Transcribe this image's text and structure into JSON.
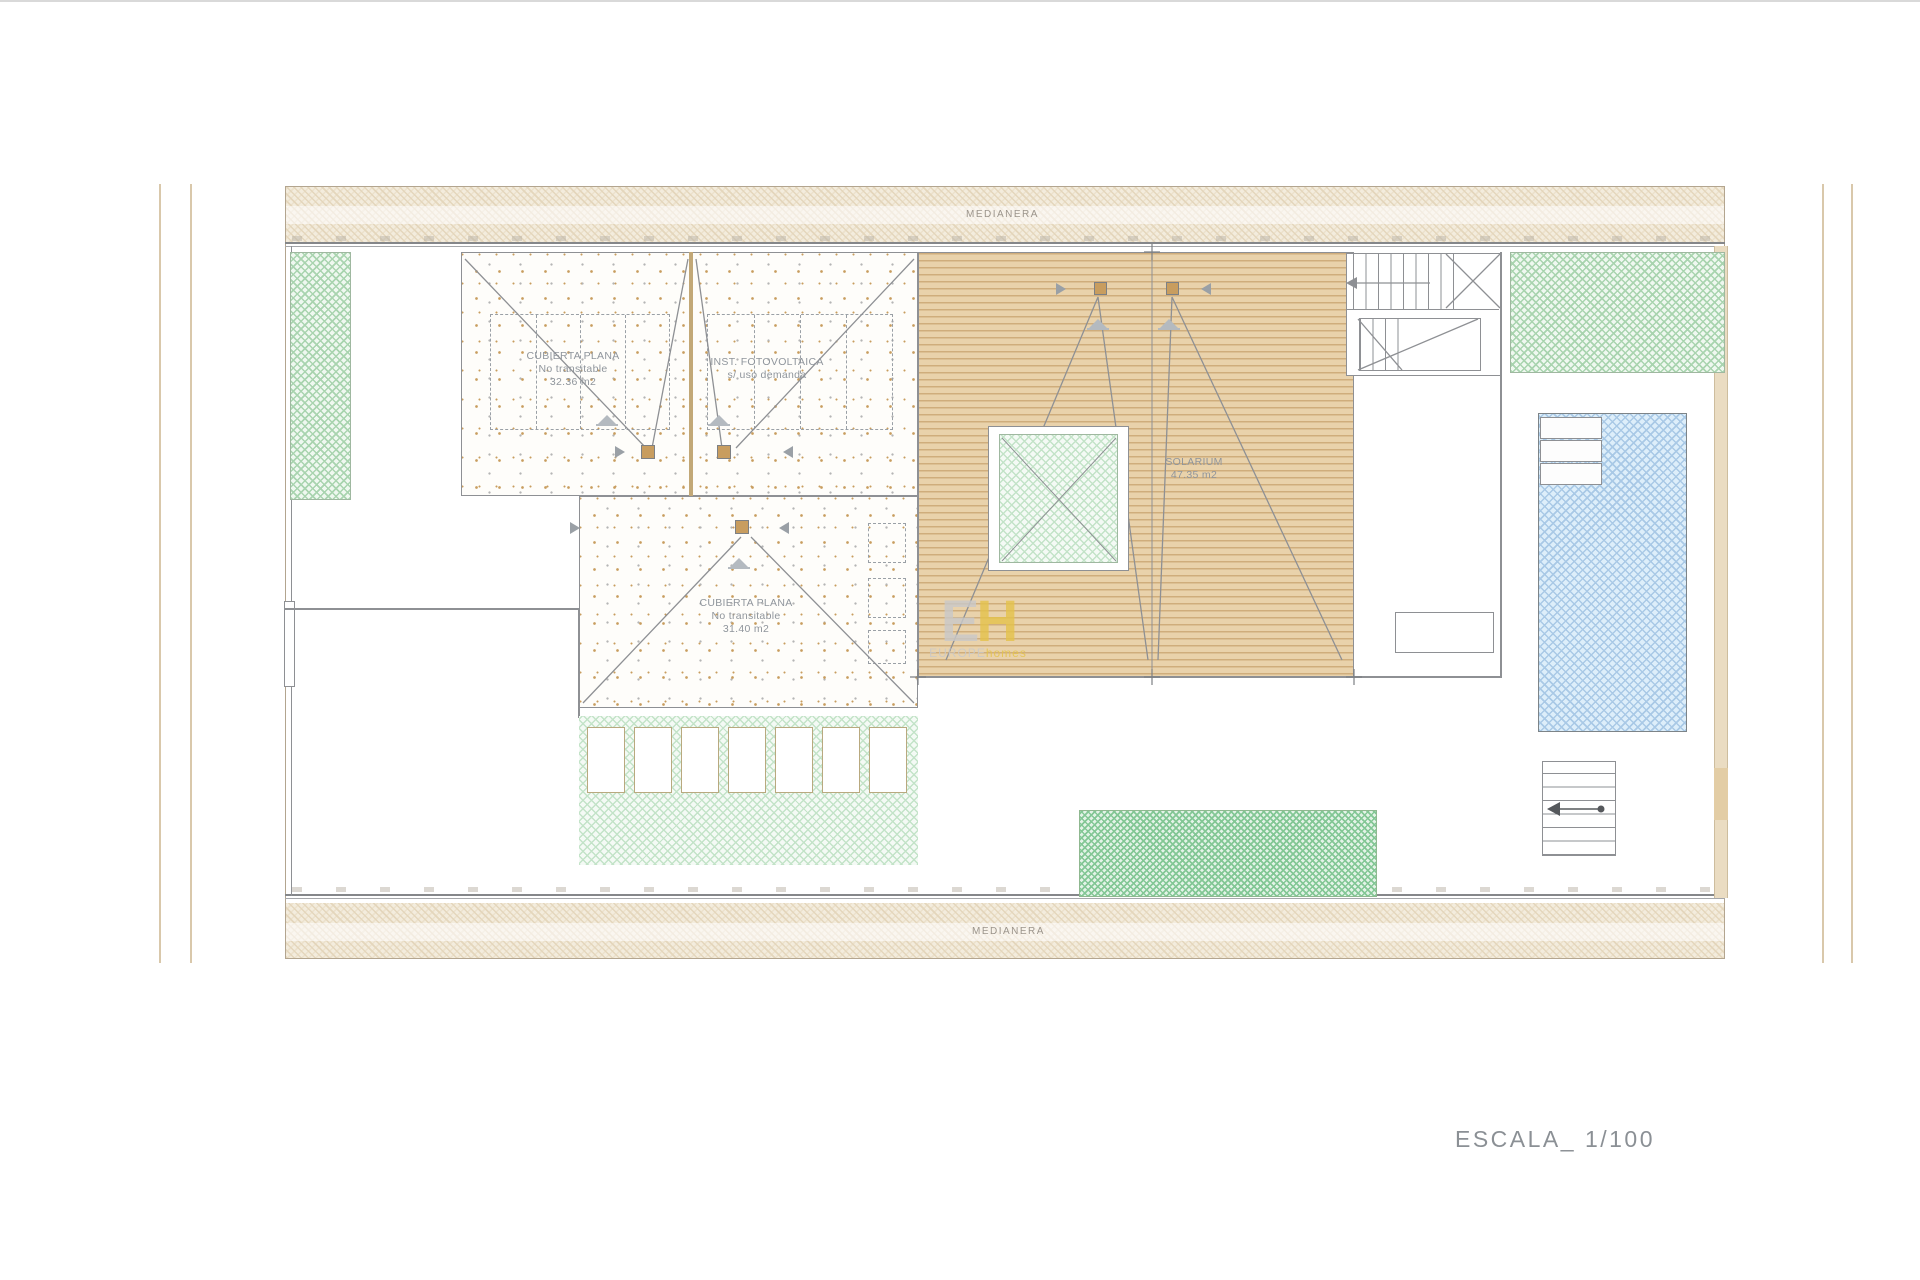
{
  "page": {
    "scale_label": "ESCALA_ 1/100"
  },
  "plan": {
    "party_wall_top": "MEDIANERA",
    "party_wall_bottom": "MEDIANERA",
    "roof_flat_1": {
      "line1": "CUBIERTA PLANA",
      "line2": "No transitable",
      "area": "32.36 m2"
    },
    "photovoltaic": {
      "line1": "INST. FOTOVOLTAICA",
      "line2": "s/ uso demanda"
    },
    "roof_flat_2": {
      "line1": "CUBIERTA PLANA",
      "line2": "No transitable",
      "area": "31.40 m2"
    },
    "solarium": {
      "name": "SOLARIUM",
      "area": "47.35 m2"
    }
  },
  "watermark": {
    "initial_e": "E",
    "initial_h": "H",
    "word_primary": "EUROPE",
    "word_secondary": "homes"
  },
  "colors": {
    "line": "#8e9094",
    "wall_dark": "#85878a",
    "beige_line": "#d9c8ab",
    "sand_bg": "#f3ecdd",
    "sand_hatch_a": "#e4d6bc",
    "sand_hatch_b": "#ece1cc",
    "speckle_brown": "#c89d5f",
    "speckle_gray": "#b5b5b5",
    "green_hatch": "#a9d4af",
    "green_bg": "#eff8f0",
    "green_hatch_light": "#c3e3c8",
    "green_bg_light": "#f4faf5",
    "green_hatch_dark": "#83c795",
    "green_bg_dark": "#e3f3e7",
    "deck_bg": "#e9d2ab",
    "deck_line": "#cfad7c",
    "pool_bg": "#ddeefa",
    "pool_hatch": "#a9c9e6",
    "beige_wall": "#eadcc2",
    "label": "#8f959c",
    "muted": "#9b948b",
    "scale_text": "#8b9095",
    "wm_gray": "#c9c9c9",
    "wm_yellow": "#e5c34b",
    "panel_dash": "#9aa0a6",
    "chimney": "#c89d5f",
    "slat_border": "#b9a97f"
  }
}
